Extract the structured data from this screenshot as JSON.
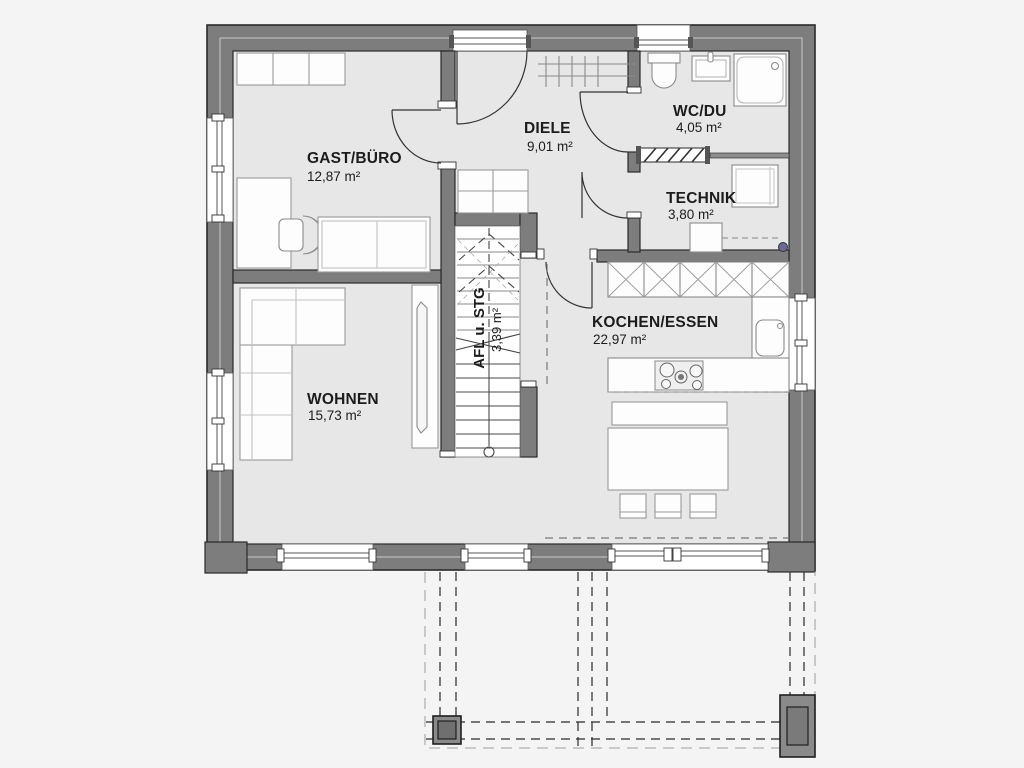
{
  "plan": {
    "title": "Erdgeschoss Grundriss",
    "rooms": [
      {
        "name": "GAST/BÜRO",
        "area": "12,87 m²"
      },
      {
        "name": "DIELE",
        "area": "9,01 m²"
      },
      {
        "name": "WC/DU",
        "area": "4,05 m²"
      },
      {
        "name": "TECHNIK",
        "area": "3,80 m²"
      },
      {
        "name": "KOCHEN/ESSEN",
        "area": "22,97 m²"
      },
      {
        "name": "WOHNEN",
        "area": "15,73 m²"
      }
    ],
    "stair": {
      "name": "AFL u. STG",
      "area": "3,39 m²"
    },
    "colors": {
      "background": "#f4f4f4",
      "floor": "#e7e7e7",
      "wall": "#7d7d7d",
      "outline": "#2a2a2a",
      "furniture_fill": "#fdfdfd",
      "furniture_stroke": "#9a9a9a",
      "marker_dot": "#6a6a99"
    }
  }
}
